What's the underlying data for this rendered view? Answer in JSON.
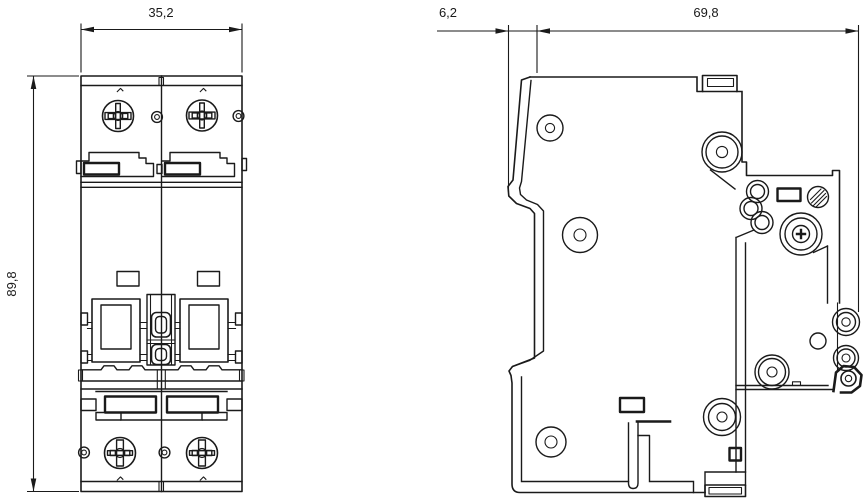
{
  "drawing": {
    "background_color": "#ffffff",
    "line_color": "#1a1a1a",
    "dimensions": {
      "front_width": "35,2",
      "front_height": "89,8",
      "side_front_offset": "6,2",
      "side_depth": "69,8"
    }
  }
}
